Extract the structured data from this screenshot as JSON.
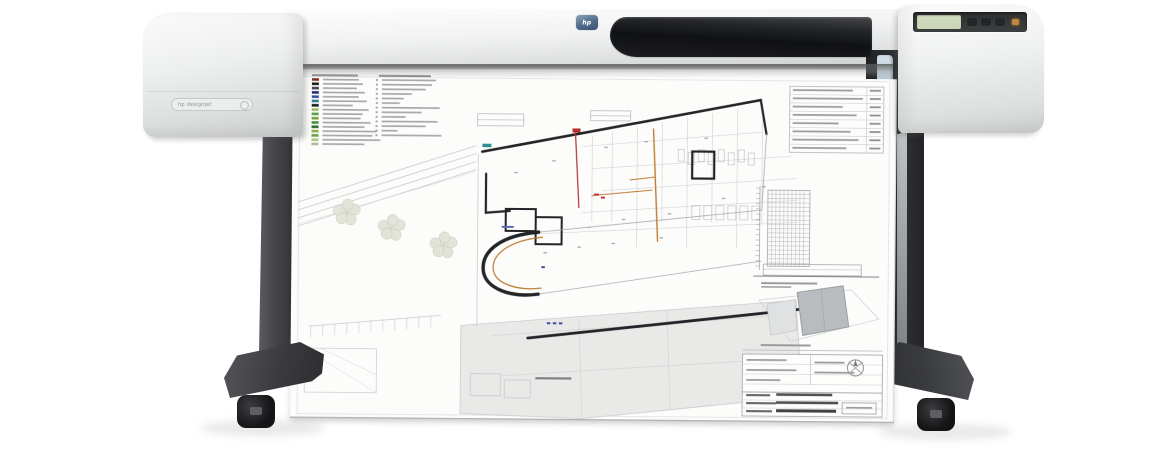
{
  "scene": {
    "background": "#ffffff",
    "description": "Large-format inkjet plotter on a stand printing an architectural floor-plan sheet"
  },
  "printer": {
    "brand_logo": "hp",
    "model_label": "hp designjet",
    "body_color": "#eef0ef",
    "window_color": "#17181b",
    "control_panel": {
      "lcd_color": "#c9d4b6",
      "strip_color": "#333436",
      "power_led_color": "#c2853c"
    },
    "media_lever_color": "#b4c3cf"
  },
  "stand": {
    "leg_color": "#434448",
    "foot_color": "#3a3b3f",
    "caster_color": "#151517",
    "rail_color": "#9a9c9e"
  },
  "sheet": {
    "paper_color": "#fcfcfb",
    "legend": {
      "swatches": [
        "#8a2a22",
        "#1c1c1e",
        "#43444a",
        "#23306e",
        "#2f4f9e",
        "#2b7e88",
        "#1a1b1d",
        "#9cbd68",
        "#5c9e4d",
        "#78a03e",
        "#4e8e3c",
        "#2f6a32",
        "#8dad4a",
        "#6a9e49",
        "#a7c87e",
        "#b4b798"
      ]
    },
    "plan_colors": {
      "walls": "#232428",
      "thin": "#a9abad",
      "faint": "#c9cbcc",
      "accent_orange": "#c07a35",
      "accent_red": "#b2302a",
      "accent_blue": "#3a4e9f",
      "accent_teal": "#2f8f96",
      "vegetation_fill": "#e1e4d8",
      "vegetation_line": "#c7cbbc",
      "mass_fill": "#e9eae8",
      "text_gray": "#a6a8a9",
      "text_dark": "#4e5052"
    }
  }
}
